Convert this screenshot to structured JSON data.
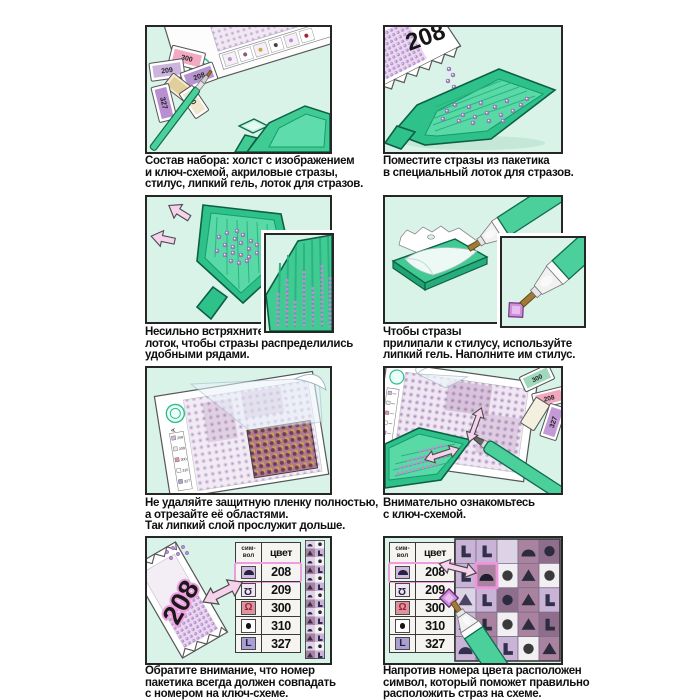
{
  "colors": {
    "panel_bg": "#d9f3e9",
    "accent_green": "#3fcb92",
    "outline_green": "#0d5f46",
    "strass_purple": "#b98fd2",
    "arrow_pink": "#f6d2ec",
    "highlight_pink": "#f093dd"
  },
  "brand": "МОСФА",
  "panels": [
    {
      "caption": "Состав набора: холст с изображением\nи ключ-схемой, акриловые стразы,\nстилус, липкий гель, лоток для стразов."
    },
    {
      "caption": "Поместите стразы из пакетика\nв специальный лоток для стразов."
    },
    {
      "caption": "Несильно встряхните\nлоток, чтобы стразы распределились\nудобными рядами."
    },
    {
      "caption": "Чтобы стразы\nприлипали к стилусу, используйте\nлипкий гель. Наполните им стилус."
    },
    {
      "caption": "Не удаляйте защитную пленку полностью,\nа отрезайте её областями.\nТак липкий слой прослужит дольше."
    },
    {
      "caption": "Внимательно ознакомьтесь\nс ключ-схемой."
    },
    {
      "caption": "Обратите внимание, что номер\nпакетика всегда должен совпадать\nс номером на ключ-схеме."
    },
    {
      "caption": "Напротив номера цвета расположен\nсимвол, который поможет правильно\nрасположить страз на схеме."
    }
  ],
  "key_table": {
    "header_symbol": "сим-\nвол",
    "header_color": "цвет",
    "rows": [
      {
        "symbol_icon": "dome-icon",
        "color": "208",
        "highlighted": true
      },
      {
        "symbol_icon": "omega-flipped-icon",
        "color": "209",
        "highlighted": false
      },
      {
        "symbol_icon": "omega-red-icon",
        "color": "300",
        "highlighted": false
      },
      {
        "symbol_icon": "dot-icon",
        "color": "310",
        "highlighted": false
      },
      {
        "symbol_icon": "letter-L-icon",
        "color": "327",
        "highlighted": false
      }
    ]
  },
  "packets": {
    "step1": [
      "300",
      "208",
      "209",
      "327",
      "0"
    ],
    "step2": "208",
    "step6": [
      "300",
      "208",
      "327"
    ],
    "step7": "208"
  }
}
